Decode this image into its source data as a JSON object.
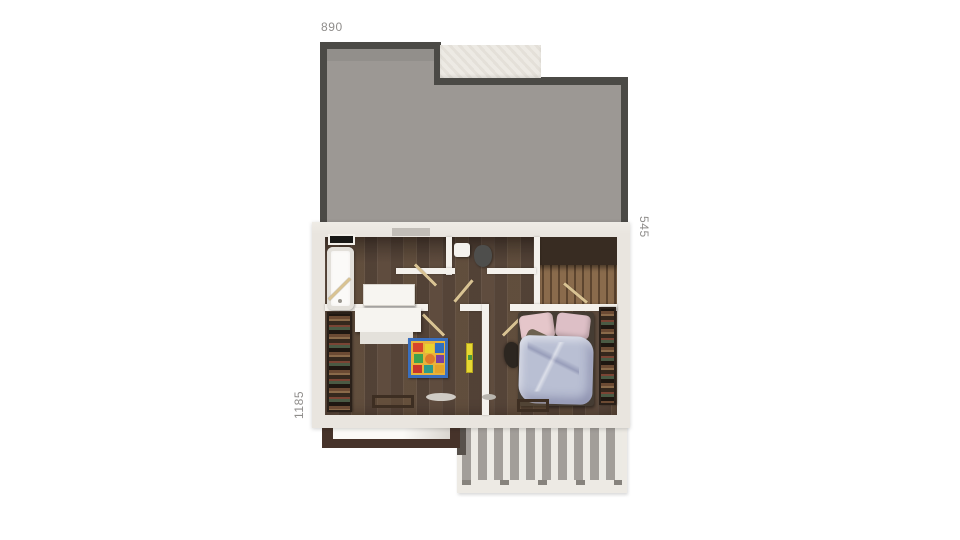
{
  "figure": {
    "type": "architectural-floor-plan-3d-top-view",
    "floor": "upper floor with roof, two bedrooms, bathroom, wc, stairwell and pergola terrace"
  },
  "dimensions": {
    "top": "890",
    "right": "545",
    "left": "1185"
  },
  "elements": [
    "roof",
    "terrace-block",
    "bathroom",
    "bathtub",
    "vanity",
    "wc",
    "toilet",
    "washbasin",
    "stairwell",
    "hallway",
    "kids-bedroom",
    "play-mat",
    "dresser",
    "wardrobe-left",
    "master-bedroom",
    "bed",
    "wardrobe-right",
    "balcony-frame",
    "pergola"
  ],
  "colors": {
    "roof_fill": "#9c9894",
    "roof_border": "#4b4a46",
    "wall": "#e9e5df",
    "wall_inner": "#f4f1ec",
    "terrace_beige": "#edeae4",
    "floor_dark": "#5f4c3e",
    "floor_mid": "#56453a",
    "stair_wood": "#7d6146",
    "door_wood": "#d9c393",
    "wardrobe_dark": "#241b15",
    "bed_duvet": "#b9bfd3",
    "pillow_pink": "#e5c6ca",
    "mat_blue": "#3a6fbe",
    "accent_mat": "#e8b33a",
    "accent_yellow": "#e6d832",
    "pergola_slat": "#a29e99",
    "balcony_frame": "#46332a",
    "label_gray": "#8f8d8b"
  }
}
